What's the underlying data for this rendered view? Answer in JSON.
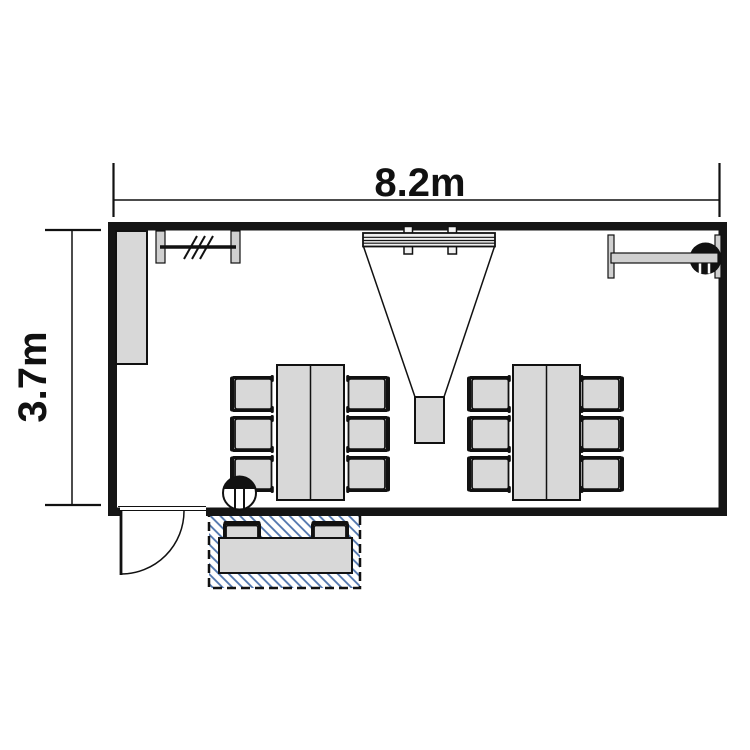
{
  "diagram": {
    "type": "floor-plan",
    "room_name": "meeting-room",
    "dimensions": {
      "width_label": "8.2m",
      "height_label": "3.7m"
    },
    "colors": {
      "background": "#ffffff",
      "wall": "#151515",
      "line": "#111111",
      "furniture_fill": "#d8d8d8",
      "bracket_fill": "#d0d0d0",
      "hatch_line": "#4c72ab"
    },
    "furniture": [
      {
        "name": "cabinet",
        "count": 1
      },
      {
        "name": "wall-whiteboard",
        "count": 1
      },
      {
        "name": "projection-screen",
        "count": 1
      },
      {
        "name": "projector",
        "count": 1
      },
      {
        "name": "wall-rail-with-camera",
        "count": 1
      },
      {
        "name": "meeting-table",
        "count": 2
      },
      {
        "name": "chair",
        "count": 12
      },
      {
        "name": "entry-bench-table",
        "count": 1
      },
      {
        "name": "bench-chair",
        "count": 2
      },
      {
        "name": "door",
        "count": 1
      },
      {
        "name": "hatched-entry-zone",
        "count": 1
      },
      {
        "name": "round-fixture-symbol",
        "count": 2
      }
    ]
  }
}
